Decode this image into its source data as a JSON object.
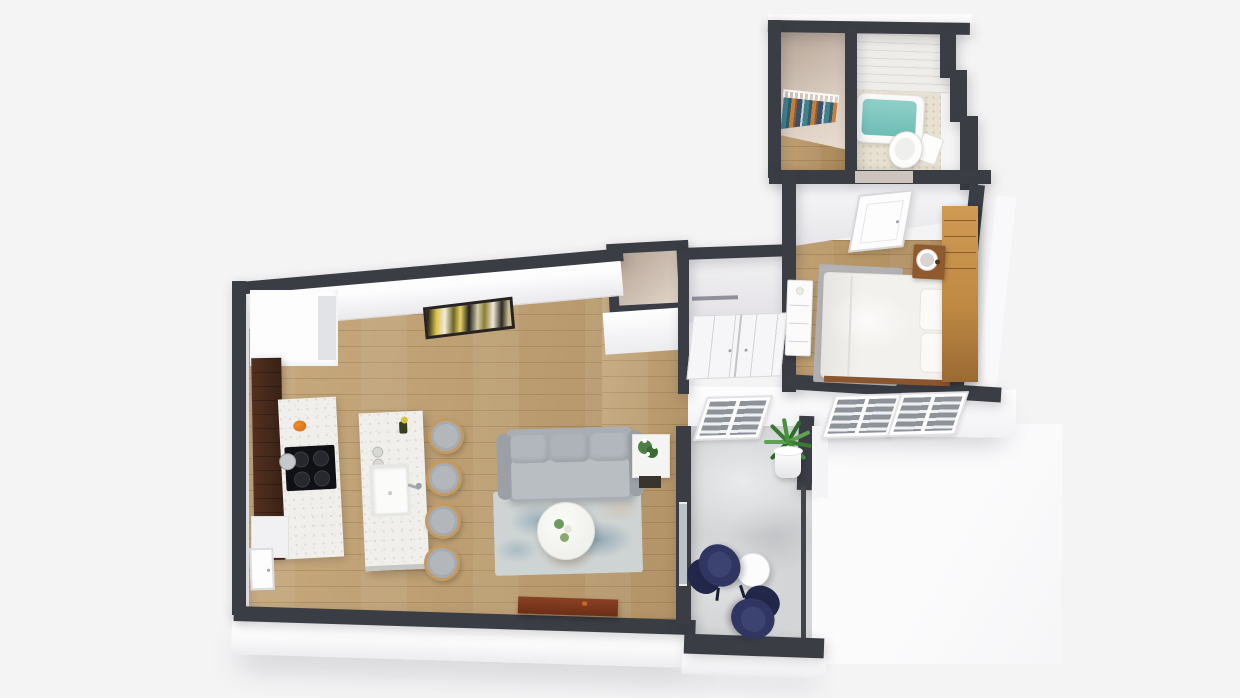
{
  "scene": {
    "description": "3D isometric floor plan rendering of a one-bedroom apartment with balcony",
    "background": "#f4f4f5"
  },
  "palette": {
    "wall_dark": "#3a3d44",
    "wall_face_white": "#ffffff",
    "interior_beige": "#dccfc2",
    "hardwood": "#bda076",
    "concrete": "#d3d5d7",
    "quartz_speckle": "#f0efeb",
    "espresso_cabinet": "#46281c",
    "tub_water": "#7ec6bf",
    "sofa_gray": "#aaafb5",
    "rug_blue": "#7ba6b6",
    "lounge_navy": "#303561",
    "wood_furniture": "#c9924f",
    "console_brown": "#7c3a1f",
    "art_yellow": "#d8c149",
    "plant_green": "#3f7c37",
    "pumpkin_orange": "#df7519"
  },
  "rooms": {
    "kitchen": {
      "label": "Kitchen",
      "floor": "hardwood",
      "features": [
        "espresso cabinet run",
        "black cooktop with pot",
        "white quartz counters",
        "quartz island with undermount sink and faucet",
        "4 rattan bar stools",
        "pumpkin decor",
        "refrigerator nook",
        "entry door"
      ]
    },
    "living": {
      "label": "Living Room",
      "floor": "hardwood",
      "features": [
        "gray three-seat sofa with three back pillows",
        "abstract yellow-black wall art",
        "blue distressed area rug",
        "round white coffee table with flowers",
        "side table with white flower plant",
        "dark red-brown media console",
        "sliding door to balcony"
      ]
    },
    "hallway": {
      "label": "Entry Hall",
      "floor": "hardwood",
      "features": [
        "small entry closet",
        "double-door hall closet with shelf",
        "white three-drawer dresser"
      ]
    },
    "bedroom": {
      "label": "Bedroom",
      "floor": "hardwood",
      "features": [
        "white bed with two pillows",
        "tall wood headboard shelf unit",
        "wood nightstand with white lamp",
        "gray area rug",
        "white interior door",
        "two exterior windows"
      ]
    },
    "walk_in_closet": {
      "label": "Walk-in Closet",
      "floor": "hardwood",
      "features": [
        "white wire shelf",
        "hanging clothes in teal, orange and navy"
      ]
    },
    "bathroom": {
      "label": "Bathroom",
      "floor": "patterned tile",
      "features": [
        "white subway tile wall",
        "soaking tub with teal water",
        "white toilet"
      ]
    },
    "balcony": {
      "label": "Balcony",
      "floor": "concrete",
      "features": [
        "two navy sculptural lounge chairs",
        "round white side table",
        "potted green plant",
        "dark railing",
        "one exterior window"
      ]
    }
  },
  "counts": {
    "bar_stools": 4,
    "windows": 3,
    "lounge_chairs": 2,
    "sofa_back_pillows": 3
  }
}
